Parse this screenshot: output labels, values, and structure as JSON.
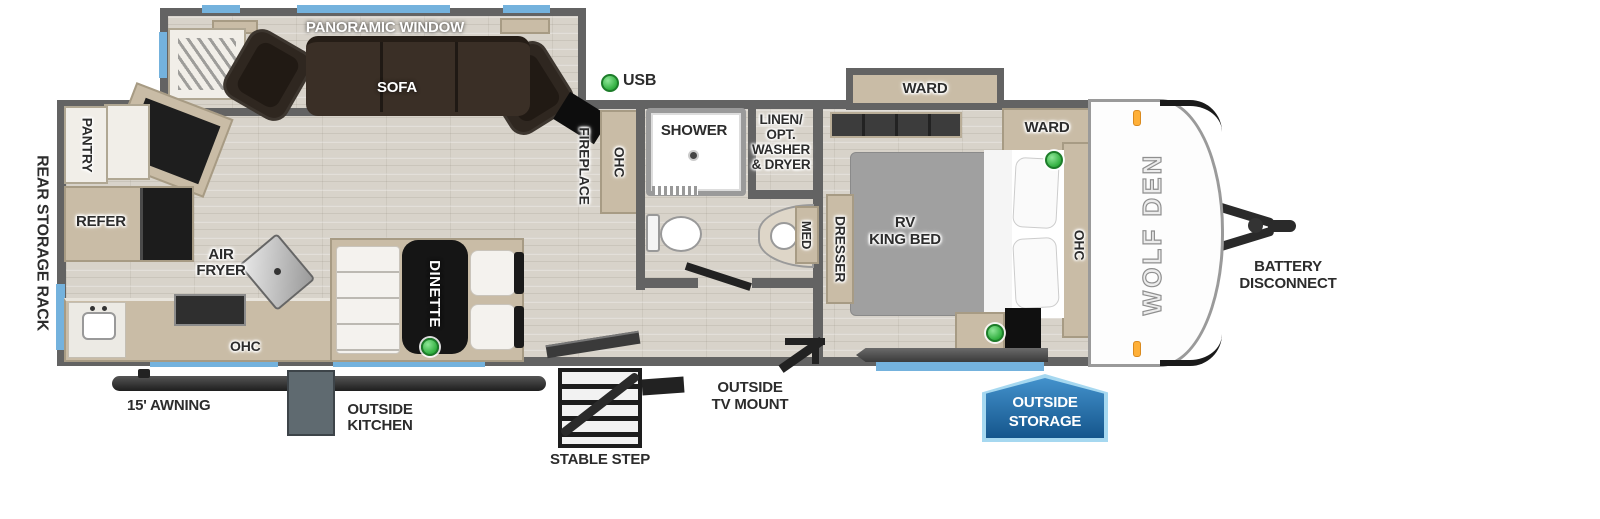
{
  "labels": {
    "rear_storage_rack": "REAR STORAGE RACK",
    "pantry": "PANTRY",
    "refer": "REFER",
    "air_fryer": [
      "AIR",
      "FRYER"
    ],
    "ohc_kitchen": "OHC",
    "dinette": "DINETTE",
    "panoramic_window": "PANORAMIC WINDOW",
    "sofa": "SOFA",
    "usb": "USB",
    "fireplace": "FIREPLACE",
    "ohc_mid": "OHC",
    "shower": "SHOWER",
    "linen": [
      "LINEN/",
      "OPT.",
      "WASHER",
      "& DRYER"
    ],
    "med": "MED",
    "dresser": "DRESSER",
    "ward_slide": "WARD",
    "ward_inner": "WARD",
    "bed": [
      "RV",
      "KING BED"
    ],
    "ohc_bedroom": "OHC",
    "brand": "WOLF DEN",
    "battery": [
      "BATTERY",
      "DISCONNECT"
    ],
    "awning": "15' AWNING",
    "outside_kitchen": [
      "OUTSIDE",
      "KITCHEN"
    ],
    "stable_step": "STABLE STEP",
    "outside_tv": [
      "OUTSIDE",
      "TV MOUNT"
    ],
    "outside_storage": [
      "OUTSIDE",
      "STORAGE"
    ]
  },
  "colors": {
    "accent_blue": "#74b2dd",
    "badge_blue": "#2a76b4",
    "usb_green": "#3cb54a",
    "wall_gray": "#636363",
    "floor": "#d8d3ca",
    "cabinet_tan": "#c9bca6",
    "sofa_brown": "#38302a"
  }
}
